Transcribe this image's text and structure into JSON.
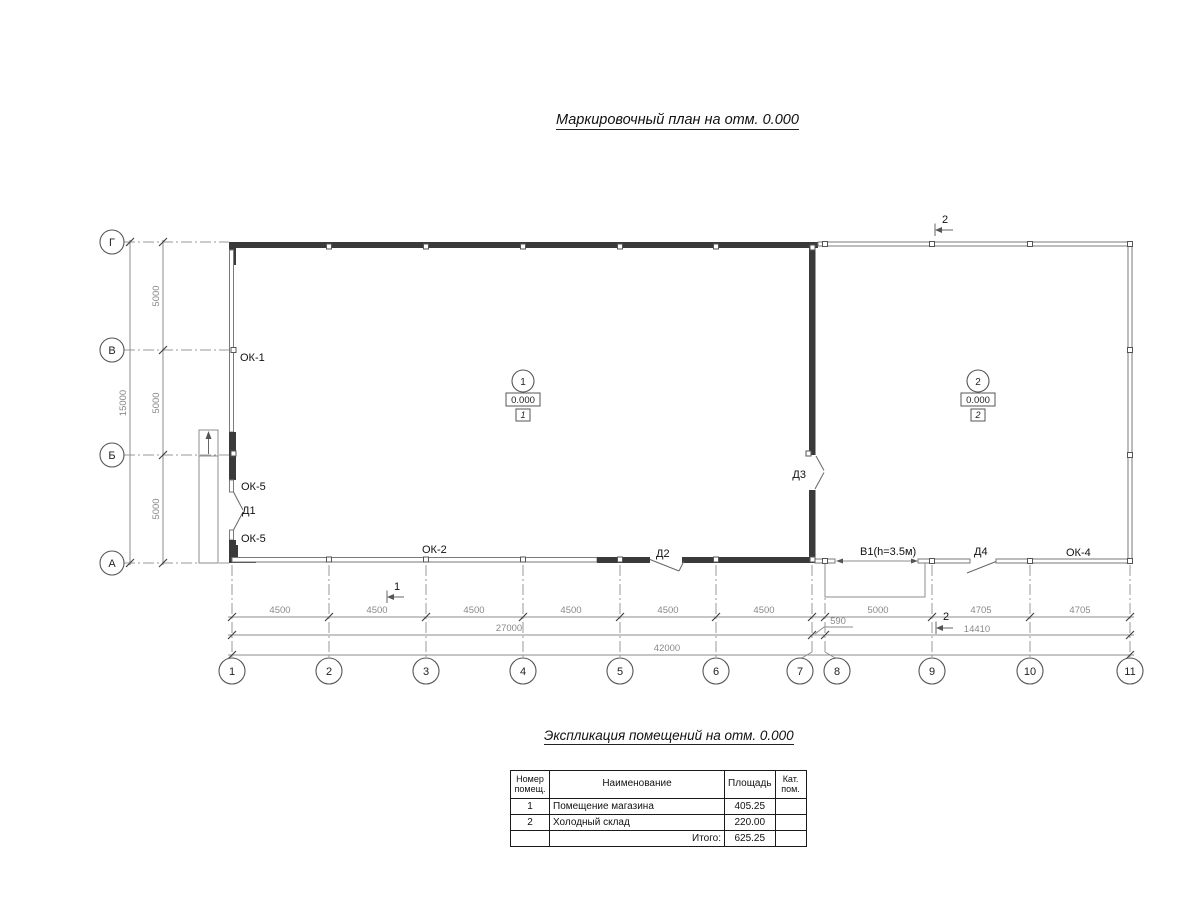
{
  "sheet": {
    "plan_title": "Маркировочный план  на отм. 0.000",
    "table_title": "Экспликация помещений на отм. 0.000"
  },
  "axes": {
    "rows": [
      "Г",
      "В",
      "Б",
      "А"
    ],
    "cols": [
      "1",
      "2",
      "3",
      "4",
      "5",
      "6",
      "7",
      "8",
      "9",
      "10",
      "11"
    ]
  },
  "dimensions": {
    "left_total": "15000",
    "left_bays": [
      "5000",
      "5000",
      "5000"
    ],
    "bottom_bays": [
      "4500",
      "4500",
      "4500",
      "4500",
      "4500",
      "4500"
    ],
    "gap_590": "590",
    "bay_5000": "5000",
    "bay_4705a": "4705",
    "bay_4705b": "4705",
    "left_span": "27000",
    "right_span": "14410",
    "total_span": "42000"
  },
  "marks": {
    "ok1": "ОК-1",
    "ok5_upper": "ОК-5",
    "d1": "Д1",
    "ok5_lower": "ОК-5",
    "ok2": "ОК-2",
    "d2": "Д2",
    "d3": "Д3",
    "v1": "В1(h=3.5м)",
    "d4": "Д4",
    "ok4": "ОК-4"
  },
  "sections": {
    "top": "2",
    "bottom_left": "1",
    "bottom_right": "2"
  },
  "rooms": [
    {
      "number": "1",
      "elevation": "0.000",
      "zone": "1"
    },
    {
      "number": "2",
      "elevation": "0.000",
      "zone": "2"
    }
  ],
  "table": {
    "headers": {
      "num1": "Номер",
      "num2": "помещ.",
      "name": "Наименование",
      "area": "Площадь",
      "cat1": "Кат.",
      "cat2": "пом."
    },
    "rows": [
      {
        "num": "1",
        "name": "Помещение магазина",
        "area": "405.25",
        "cat": ""
      },
      {
        "num": "2",
        "name": "Холодный склад",
        "area": "220.00",
        "cat": ""
      }
    ],
    "total_label": "Итого:",
    "total_area": "625.25"
  }
}
